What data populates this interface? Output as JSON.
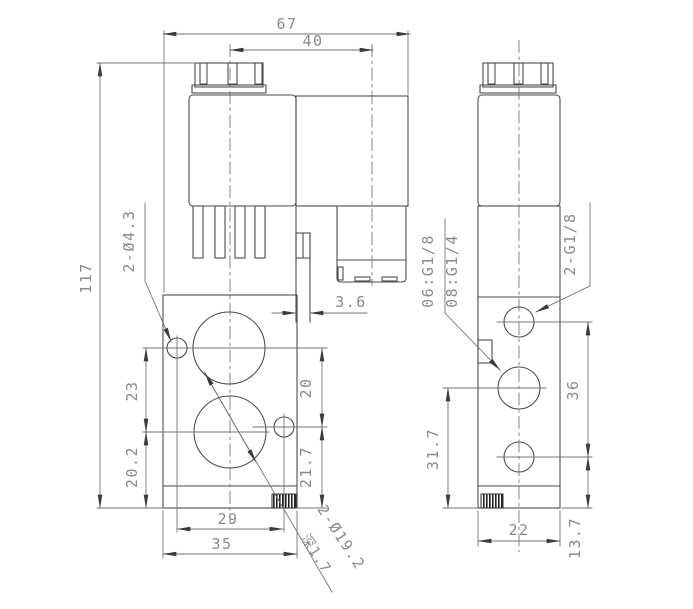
{
  "drawing_type": "valve-dimension-drawing",
  "views": {
    "front": {
      "dimensions": {
        "overall_width": "67",
        "solenoid_offset": "40",
        "overall_height": "117",
        "hole_span_upper": "23",
        "hole_span_lower": "20.2",
        "port_span_upper": "20",
        "port_span_lower": "21.7",
        "mount_hole_span": "29",
        "body_width": "35",
        "plate_thickness": "3.6"
      },
      "notes": {
        "mount_holes": "2-Ø4.3",
        "counterbore": "2-Ø19.2",
        "counterbore_depth": "深1.7"
      }
    },
    "side": {
      "dimensions": {
        "port_span": "36",
        "bottom_port_height": "13.7",
        "mid_port_height": "31.7",
        "body_depth": "22"
      },
      "notes": {
        "port_thread_06": "06:G1/8",
        "port_thread_08": "08:G1/4",
        "side_ports": "2-G1/8"
      }
    }
  },
  "colors": {
    "background": "#ffffff",
    "outline": "#4d4d4d",
    "dimension_line": "#767676",
    "dimension_text": "#8a8a8a",
    "arrow": "#3a3a3a"
  }
}
